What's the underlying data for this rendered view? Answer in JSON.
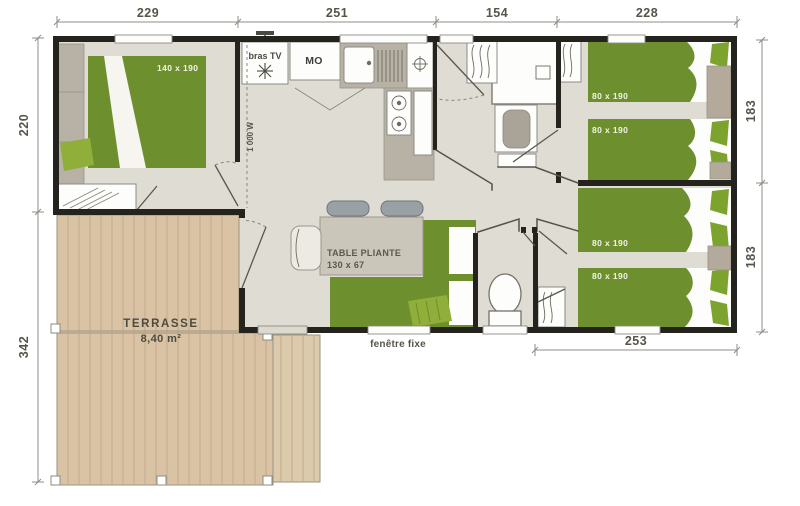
{
  "plan_type": "mobile-home floor plan with terrace",
  "dims": {
    "top": [
      "229",
      "251",
      "154",
      "228"
    ],
    "left": [
      "220",
      "342"
    ],
    "right": [
      "183",
      "183"
    ],
    "bottom": [
      "253"
    ]
  },
  "labels": {
    "master_bed": "140 x 190",
    "single_bed": "80 x 190",
    "tv": "bras TV",
    "microwave": "MO",
    "heater": "1 000 W",
    "table1": "TABLE PLIANTE",
    "table2": "130 x 67",
    "terrace": "TERRASSE",
    "terrace_area": "8,40 m²",
    "fixed_window": "fenêtre fixe"
  },
  "colors": {
    "wall": "#24231e",
    "floor": "#dfdcd3",
    "bed_green": "#6e8f2d",
    "accent_green": "#8fae3a",
    "terrace_wood": "#d9c3a4",
    "furniture_grey": "#b7b2a5"
  }
}
